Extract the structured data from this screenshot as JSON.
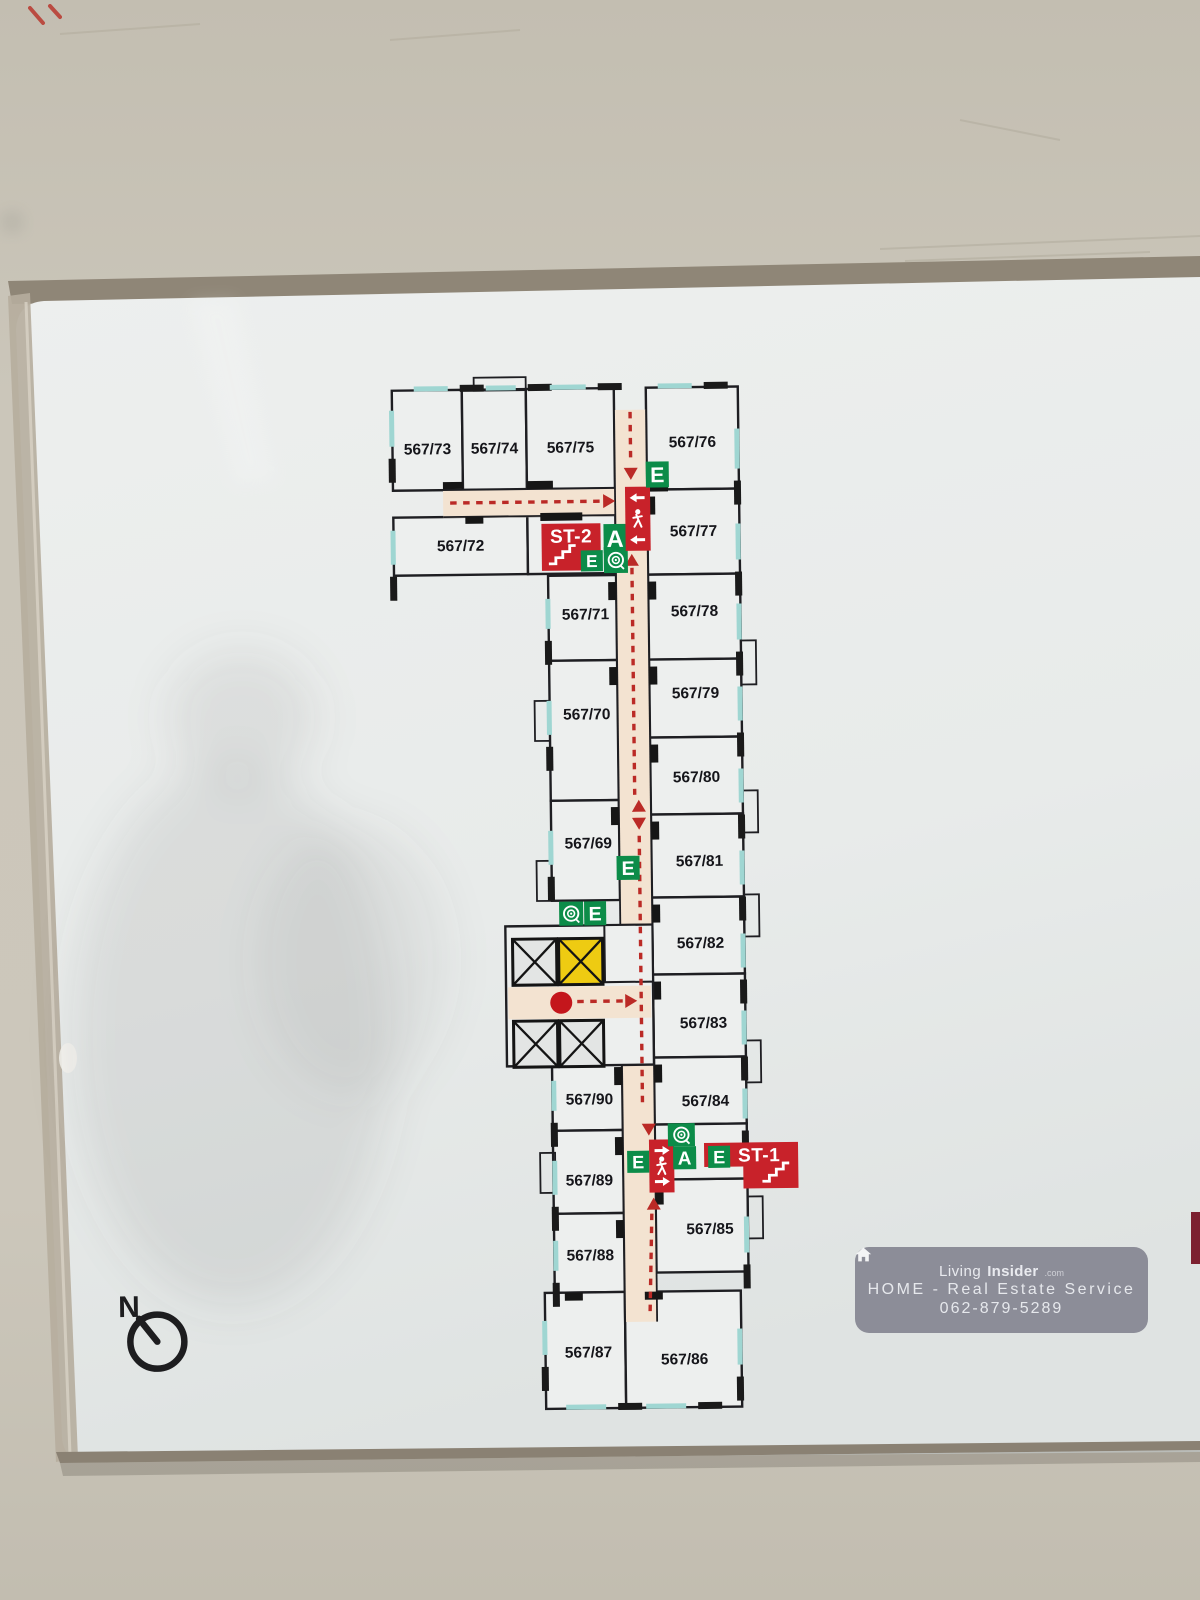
{
  "scene": {
    "wall_color": "#c8c3b7",
    "wall_color_dark": "#bcb7ab",
    "board_color": "#eaedeb",
    "board_color_low": "#dfe3e2",
    "frame_dark": "#8f8677",
    "frame_light": "#b6ad9d",
    "line_color": "#1e1e22",
    "accent_red": "#c8222a",
    "dash_red": "#bb2a26",
    "accent_green": "#0c8c49",
    "elevator_yellow": "#eecb12",
    "corridor_color": "#f3e3d1",
    "window_color": "#9fd6d2",
    "room_fill": "#edefee",
    "shadow_color": "#5f5f5c",
    "edge_red_object": "#7c2030"
  },
  "compass": {
    "label": "N"
  },
  "watermark": {
    "icon": "house-icon",
    "brand_prefix": "Living",
    "brand_bold": "Insider",
    "brand_suffix": ".com",
    "line2": "HOME - Real Estate Service",
    "line3": "062-879-5289"
  },
  "plan": {
    "rooms": [
      {
        "label": "567/73",
        "x": 398,
        "y": 388,
        "w": 70,
        "h": 100,
        "lx": 433,
        "ly": 452,
        "ext": "N"
      },
      {
        "label": "567/74",
        "x": 468,
        "y": 388,
        "w": 64,
        "h": 100,
        "lx": 500,
        "ly": 452,
        "ext": "N"
      },
      {
        "label": "567/75",
        "x": 532,
        "y": 388,
        "w": 88,
        "h": 100,
        "lx": 576,
        "ly": 452,
        "ext": "N"
      },
      {
        "label": "567/76",
        "x": 652,
        "y": 388,
        "w": 92,
        "h": 102,
        "lx": 698,
        "ly": 448,
        "ext": "N"
      },
      {
        "label": "567/72",
        "x": 398,
        "y": 515,
        "w": 134,
        "h": 58,
        "lx": 465,
        "ly": 549,
        "ext": "W"
      },
      {
        "label": "567/77",
        "x": 652,
        "y": 490,
        "w": 92,
        "h": 85,
        "lx": 698,
        "ly": 537,
        "ext": "E"
      },
      {
        "label": "567/71",
        "x": 552,
        "y": 575,
        "w": 68,
        "h": 85,
        "lx": 589,
        "ly": 619,
        "ext": "W"
      },
      {
        "label": "567/78",
        "x": 652,
        "y": 575,
        "w": 92,
        "h": 85,
        "lx": 698,
        "ly": 617,
        "ext": "E"
      },
      {
        "label": "567/70",
        "x": 552,
        "y": 660,
        "w": 68,
        "h": 140,
        "lx": 589,
        "ly": 719,
        "ext": "W"
      },
      {
        "label": "567/79",
        "x": 652,
        "y": 660,
        "w": 92,
        "h": 78,
        "lx": 698,
        "ly": 699,
        "ext": "E"
      },
      {
        "label": "567/80",
        "x": 652,
        "y": 738,
        "w": 92,
        "h": 77,
        "lx": 698,
        "ly": 783,
        "ext": "E"
      },
      {
        "label": "567/69",
        "x": 552,
        "y": 800,
        "w": 68,
        "h": 100,
        "lx": 589,
        "ly": 848,
        "ext": "W"
      },
      {
        "label": "567/81",
        "x": 652,
        "y": 815,
        "w": 92,
        "h": 83,
        "lx": 700,
        "ly": 867,
        "ext": "E"
      },
      {
        "label": "567/82",
        "x": 652,
        "y": 898,
        "w": 92,
        "h": 77,
        "lx": 700,
        "ly": 949,
        "ext": "E"
      },
      {
        "label": "567/83",
        "x": 652,
        "y": 975,
        "w": 92,
        "h": 83,
        "lx": 702,
        "ly": 1029,
        "ext": "E"
      },
      {
        "label": "567/90",
        "x": 550,
        "y": 1060,
        "w": 70,
        "h": 70,
        "lx": 587,
        "ly": 1104,
        "ext": "W"
      },
      {
        "label": "567/84",
        "x": 652,
        "y": 1058,
        "w": 92,
        "h": 67,
        "lx": 703,
        "ly": 1107,
        "ext": "E"
      },
      {
        "label": "567/89",
        "x": 550,
        "y": 1130,
        "w": 70,
        "h": 83,
        "lx": 586,
        "ly": 1185,
        "ext": "W"
      },
      {
        "label": "567/85",
        "x": 652,
        "y": 1180,
        "w": 92,
        "h": 93,
        "lx": 706,
        "ly": 1235,
        "ext": "E"
      },
      {
        "label": "567/88",
        "x": 550,
        "y": 1213,
        "w": 70,
        "h": 79,
        "lx": 586,
        "ly": 1260,
        "ext": "W"
      },
      {
        "label": "567/87",
        "x": 540,
        "y": 1292,
        "w": 80,
        "h": 116,
        "lx": 583,
        "ly": 1357,
        "ext": "S"
      },
      {
        "label": "567/86",
        "x": 620,
        "y": 1292,
        "w": 116,
        "h": 116,
        "lx": 679,
        "ly": 1365,
        "ext": "S"
      }
    ],
    "lobbies": [
      {
        "x": 532,
        "y": 515,
        "w": 88,
        "h": 58
      },
      {
        "x": 652,
        "y": 1125,
        "w": 92,
        "h": 55
      }
    ],
    "corridors": [
      [
        620,
        410,
        32,
        912
      ],
      [
        448,
        488,
        172,
        28
      ],
      [
        507,
        986,
        143,
        32
      ]
    ],
    "corridor_edges": [
      [
        620,
        410,
        620,
        1322
      ],
      [
        652,
        410,
        652,
        1322
      ],
      [
        448,
        488,
        620,
        488
      ],
      [
        448,
        515,
        620,
        515
      ],
      [
        507,
        986,
        650,
        986
      ],
      [
        507,
        1018,
        650,
        1018
      ]
    ],
    "windows": [
      [
        420,
        384,
        34,
        5
      ],
      [
        492,
        384,
        30,
        5
      ],
      [
        556,
        384,
        36,
        5
      ],
      [
        664,
        384,
        34,
        5
      ],
      [
        740,
        430,
        5,
        40
      ],
      [
        740,
        525,
        5,
        36
      ],
      [
        740,
        605,
        5,
        36
      ],
      [
        740,
        688,
        5,
        34
      ],
      [
        740,
        770,
        5,
        34
      ],
      [
        740,
        852,
        5,
        34
      ],
      [
        740,
        935,
        5,
        34
      ],
      [
        740,
        1012,
        5,
        34
      ],
      [
        740,
        1090,
        5,
        30
      ],
      [
        740,
        1218,
        5,
        36
      ],
      [
        732,
        1330,
        5,
        36
      ],
      [
        640,
        1404,
        40,
        5
      ],
      [
        560,
        1404,
        40,
        5
      ],
      [
        395,
        408,
        5,
        36
      ],
      [
        395,
        528,
        5,
        34
      ],
      [
        549,
        598,
        5,
        30
      ],
      [
        549,
        700,
        5,
        34
      ],
      [
        549,
        830,
        5,
        34
      ],
      [
        549,
        1080,
        5,
        30
      ],
      [
        549,
        1160,
        5,
        34
      ],
      [
        549,
        1240,
        5,
        30
      ],
      [
        537,
        1320,
        5,
        34
      ]
    ],
    "marks": [
      [
        532,
        480,
        26,
        8
      ],
      [
        545,
        512,
        42,
        8
      ],
      [
        448,
        480,
        20,
        7
      ],
      [
        470,
        515,
        18,
        7
      ],
      [
        655,
        485,
        18,
        7
      ],
      [
        652,
        497,
        8,
        18
      ],
      [
        652,
        582,
        8,
        18
      ],
      [
        652,
        667,
        8,
        18
      ],
      [
        652,
        745,
        8,
        18
      ],
      [
        652,
        822,
        8,
        18
      ],
      [
        652,
        905,
        8,
        18
      ],
      [
        652,
        982,
        8,
        18
      ],
      [
        652,
        1065,
        8,
        18
      ],
      [
        652,
        1187,
        8,
        18
      ],
      [
        612,
        582,
        8,
        18
      ],
      [
        612,
        667,
        8,
        18
      ],
      [
        612,
        807,
        8,
        18
      ],
      [
        612,
        1067,
        8,
        18
      ],
      [
        612,
        1137,
        8,
        18
      ],
      [
        612,
        1220,
        8,
        18
      ],
      [
        560,
        1292,
        18,
        8
      ],
      [
        640,
        1292,
        18,
        8
      ]
    ],
    "balconies": [
      [
        744,
        642,
        15,
        44
      ],
      [
        744,
        792,
        15,
        42
      ],
      [
        744,
        896,
        15,
        42
      ],
      [
        744,
        1042,
        15,
        42
      ],
      [
        744,
        1198,
        15,
        42
      ],
      [
        537,
        700,
        15,
        40
      ],
      [
        537,
        860,
        15,
        40
      ],
      [
        537,
        1152,
        15,
        40
      ],
      [
        480,
        376,
        52,
        13
      ]
    ],
    "elevator": {
      "bg": [
        505,
        925,
        147,
        140
      ],
      "utility": [
        604,
        925,
        48,
        57
      ],
      "shafts": [
        [
          512,
          938,
          44,
          46,
          "gray"
        ],
        [
          558,
          938,
          44,
          46,
          "yellow"
        ],
        [
          512,
          1020,
          44,
          46,
          "gray"
        ],
        [
          558,
          1020,
          44,
          46,
          "gray"
        ]
      ],
      "dot": [
        560,
        1002,
        11
      ]
    },
    "dashes": [
      [
        636,
        412,
        636,
        464
      ],
      [
        455,
        501,
        606,
        501
      ],
      [
        636,
        568,
        636,
        795
      ],
      [
        640,
        836,
        640,
        1108
      ],
      [
        648,
        1214,
        645,
        1315
      ],
      [
        576,
        1001,
        622,
        1001
      ]
    ],
    "arrows": [
      [
        636,
        480,
        "down"
      ],
      [
        620,
        501,
        "right"
      ],
      [
        636,
        554,
        "up"
      ],
      [
        640,
        800,
        "up"
      ],
      [
        640,
        830,
        "down"
      ],
      [
        646,
        1136,
        "down"
      ],
      [
        650,
        1198,
        "up"
      ],
      [
        636,
        1001,
        "right"
      ]
    ],
    "signs": [
      {
        "type": "stair",
        "label": "ST-2",
        "x": 546,
        "y": 523,
        "w": 59,
        "h": 47,
        "stairs": "left"
      },
      {
        "type": "letter",
        "ch": "A",
        "x": 608,
        "y": 524,
        "w": 23,
        "h": 29
      },
      {
        "type": "letter",
        "ch": "E",
        "x": 585,
        "y": 550,
        "w": 22,
        "h": 21
      },
      {
        "type": "hose",
        "x": 608,
        "y": 547,
        "w": 24,
        "h": 26
      },
      {
        "type": "exit",
        "x": 630,
        "y": 487,
        "w": 25,
        "h": 64,
        "dir": "left"
      },
      {
        "type": "letter",
        "ch": "E",
        "x": 651,
        "y": 462,
        "w": 23,
        "h": 26
      },
      {
        "type": "letter",
        "ch": "E",
        "x": 617,
        "y": 856,
        "w": 23,
        "h": 24
      },
      {
        "type": "hose",
        "x": 559,
        "y": 901,
        "w": 24,
        "h": 24
      },
      {
        "type": "letter",
        "ch": "E",
        "x": 584,
        "y": 901,
        "w": 22,
        "h": 24
      },
      {
        "type": "exit",
        "x": 646,
        "y": 1140,
        "w": 25,
        "h": 53,
        "dir": "right"
      },
      {
        "type": "letter",
        "ch": "E",
        "x": 624,
        "y": 1151,
        "w": 22,
        "h": 22
      },
      {
        "type": "hose",
        "x": 665,
        "y": 1124,
        "w": 27,
        "h": 23
      },
      {
        "type": "letter",
        "ch": "A",
        "x": 670,
        "y": 1147,
        "w": 23,
        "h": 23
      },
      {
        "type": "stair",
        "label": "ST-1",
        "x": 701,
        "y": 1144,
        "w": 94,
        "h": 46,
        "stairs": "right",
        "notch": true
      },
      {
        "type": "letter",
        "ch": "E",
        "x": 705,
        "y": 1147,
        "w": 22,
        "h": 22
      }
    ],
    "compass": {
      "cx": 152,
      "cy": 1336,
      "r": 27,
      "needle": [
        134,
        1313
      ],
      "nx": 124,
      "ny": 1311
    }
  }
}
